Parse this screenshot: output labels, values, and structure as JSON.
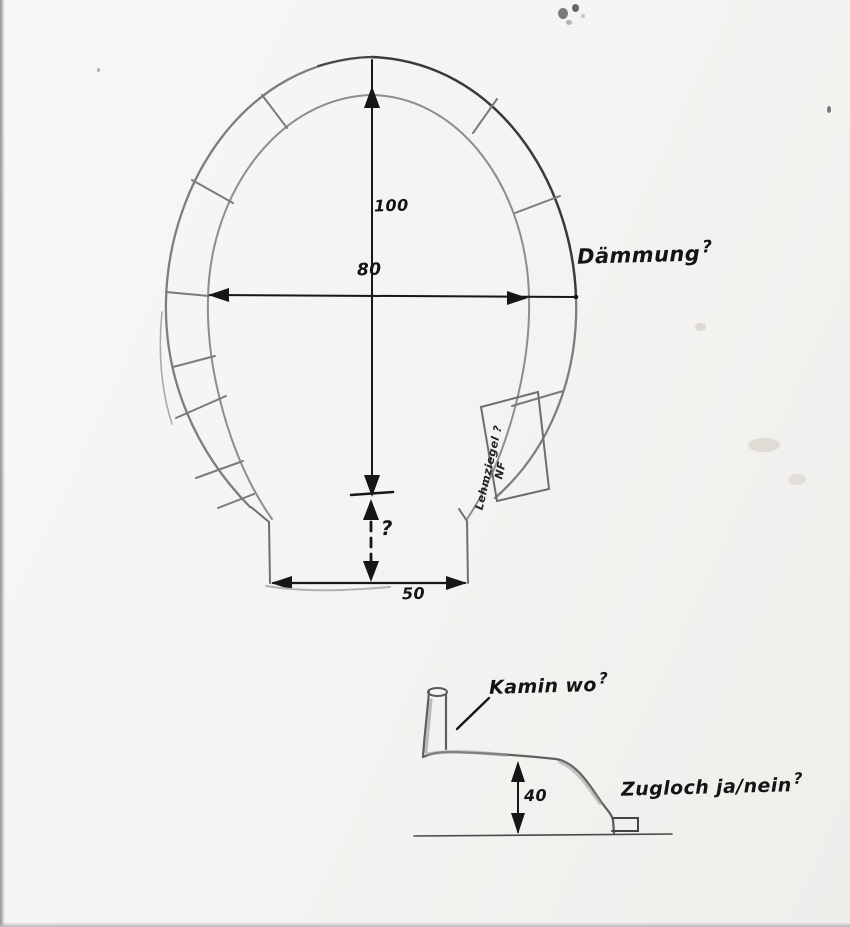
{
  "colors": {
    "ink": "#161616",
    "pencil": "#7e7e7e",
    "paper": "#f6f5f3"
  },
  "front_view": {
    "dim_height": "100",
    "dim_width": "80",
    "dim_opening": "50",
    "dim_unknown": "?",
    "insulation": {
      "text": "Dämmung",
      "qmark": "?"
    },
    "brick_line1": "Lehmziegel ?",
    "brick_line2": "NF"
  },
  "side_view": {
    "chimney": {
      "text": "Kamin wo",
      "qmark": "?"
    },
    "dim_height": "40",
    "draft": {
      "text": "Zugloch ja/nein",
      "qmark": "?"
    }
  }
}
